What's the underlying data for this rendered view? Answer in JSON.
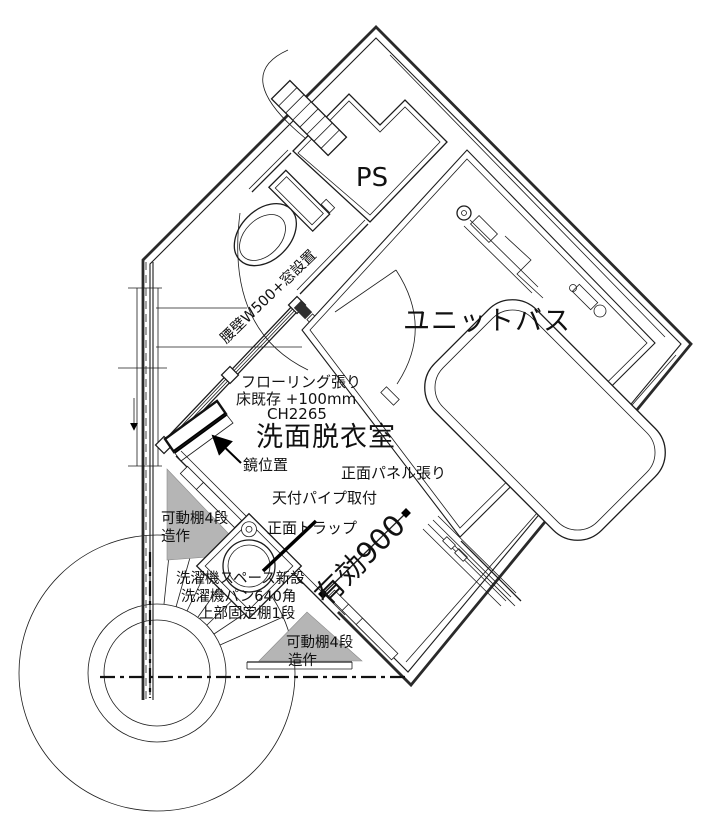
{
  "page": {
    "background": "#ffffff",
    "ink": "#1a1a1a",
    "shelf_gray": "#b5b5b5"
  },
  "plan": {
    "rooms": {
      "ps_label": "PS",
      "unit_bath_label": "ユニットバス",
      "washroom_label": "洗面脱衣室"
    },
    "annotations": {
      "koshikabe": "腰壁W500+窓設置",
      "flooring": "フローリング張り",
      "floor_existing": "床既存 +100mm",
      "ceiling_height": "CH2265",
      "mirror": "鏡位置",
      "front_panel": "正面パネル張り",
      "ceiling_pipe": "天付パイプ取付",
      "front_trap": "正面トラップ",
      "shelf_left_line1": "可動棚4段",
      "shelf_left_line2": "造作",
      "effective_width": "有効900",
      "washer_space": "洗濯機スペース新設",
      "washer_pan": "洗濯機パン640角",
      "fixed_shelf": "上部固定棚1段",
      "shelf_bottom_line1": "可動棚4段",
      "shelf_bottom_line2": "造作"
    }
  }
}
